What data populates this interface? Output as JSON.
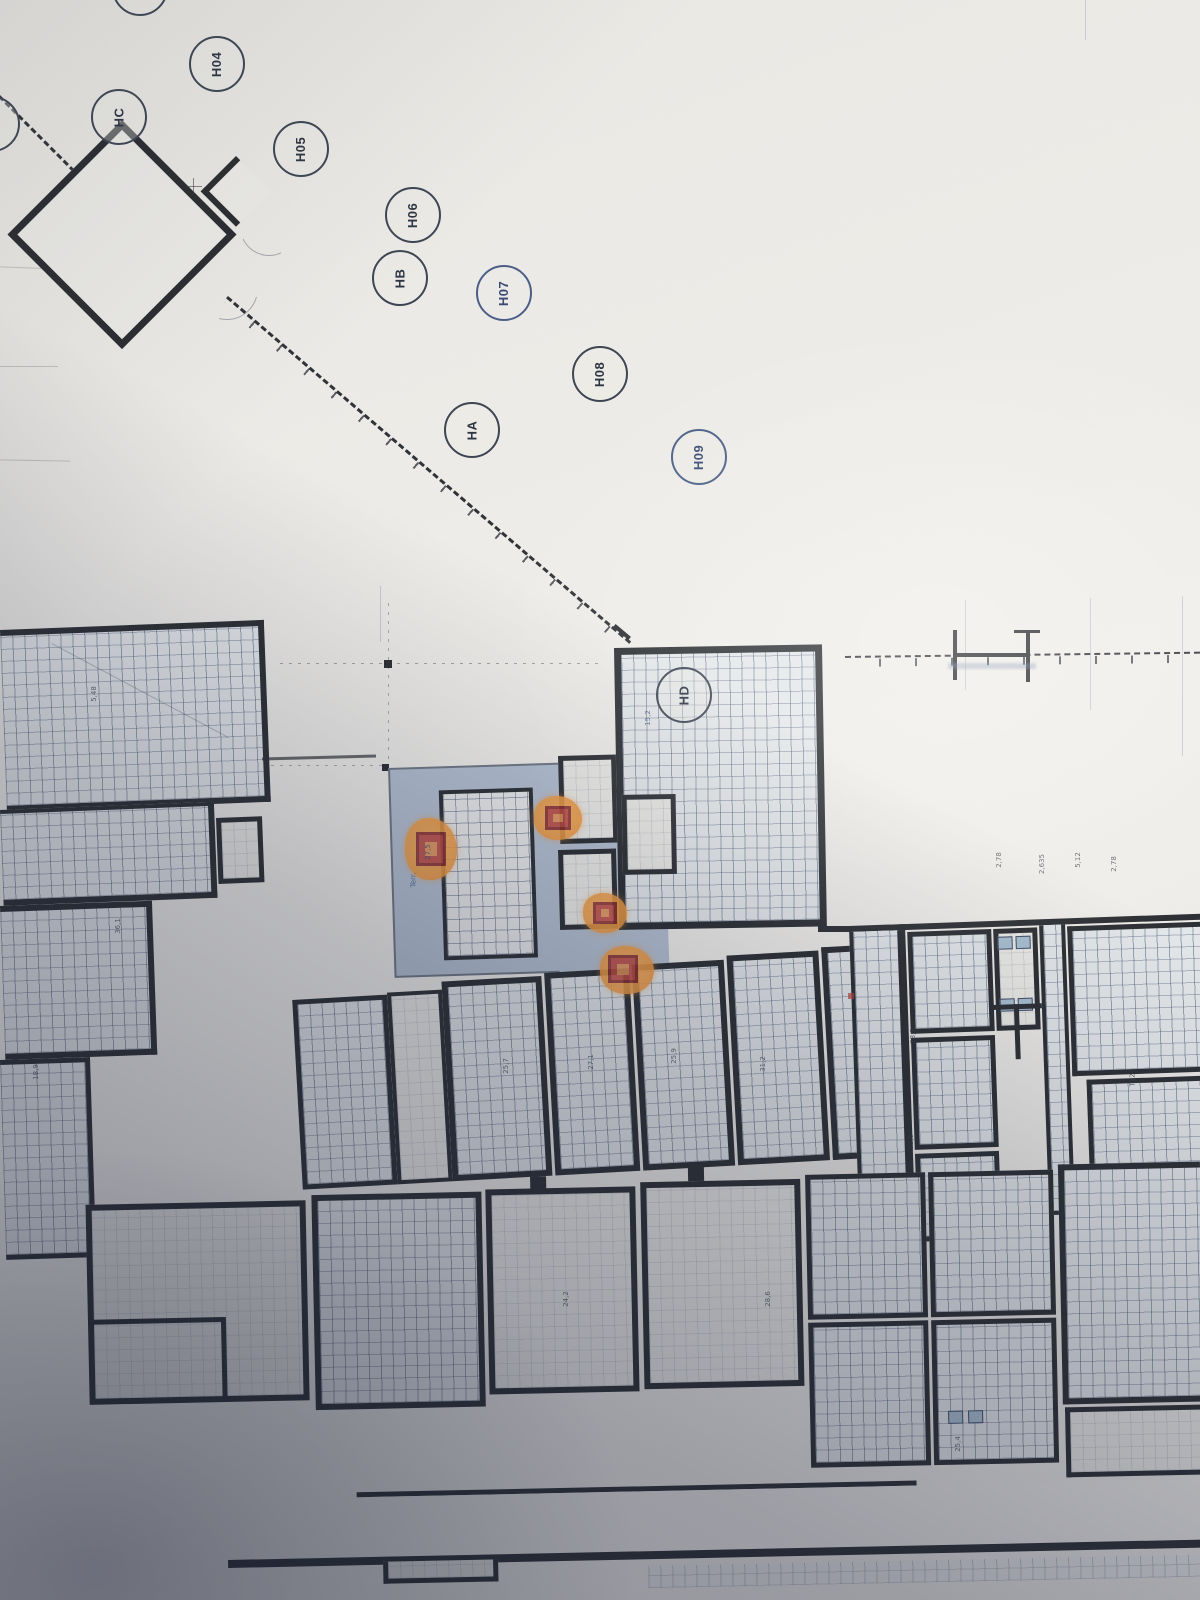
{
  "boundary_labels": [
    {
      "label": "HC"
    },
    {
      "label": "H04"
    },
    {
      "label": "H05"
    },
    {
      "label": "H06"
    },
    {
      "label": "HB"
    },
    {
      "label": "H07"
    },
    {
      "label": "H08"
    },
    {
      "label": "HA"
    },
    {
      "label": "H09"
    },
    {
      "label": "HD"
    }
  ],
  "annotations": [
    {
      "text": "5,48"
    },
    {
      "text": "36,1"
    },
    {
      "text": "27,5"
    },
    {
      "text": "Terr."
    },
    {
      "text": "2,78"
    },
    {
      "text": "2,635"
    },
    {
      "text": "5,12"
    },
    {
      "text": "2,78"
    },
    {
      "text": "25,7"
    },
    {
      "text": "27,1"
    },
    {
      "text": "25,9"
    },
    {
      "text": "T12"
    },
    {
      "text": "28,3"
    },
    {
      "text": "22,6"
    },
    {
      "text": "15,2"
    },
    {
      "text": "18,9"
    },
    {
      "text": "24,2"
    },
    {
      "text": "31,2"
    },
    {
      "text": "28,6"
    },
    {
      "text": "25,4"
    }
  ],
  "colors": {
    "wall": "#2d3034",
    "hatch_line": "#4d5c78",
    "courtyard_fill": "#b4c0d1",
    "highlight_orange": "#f09a3f",
    "highlight_red": "#c04a40",
    "paper": "#edebe7",
    "shadow_tint": "#1f2740"
  }
}
